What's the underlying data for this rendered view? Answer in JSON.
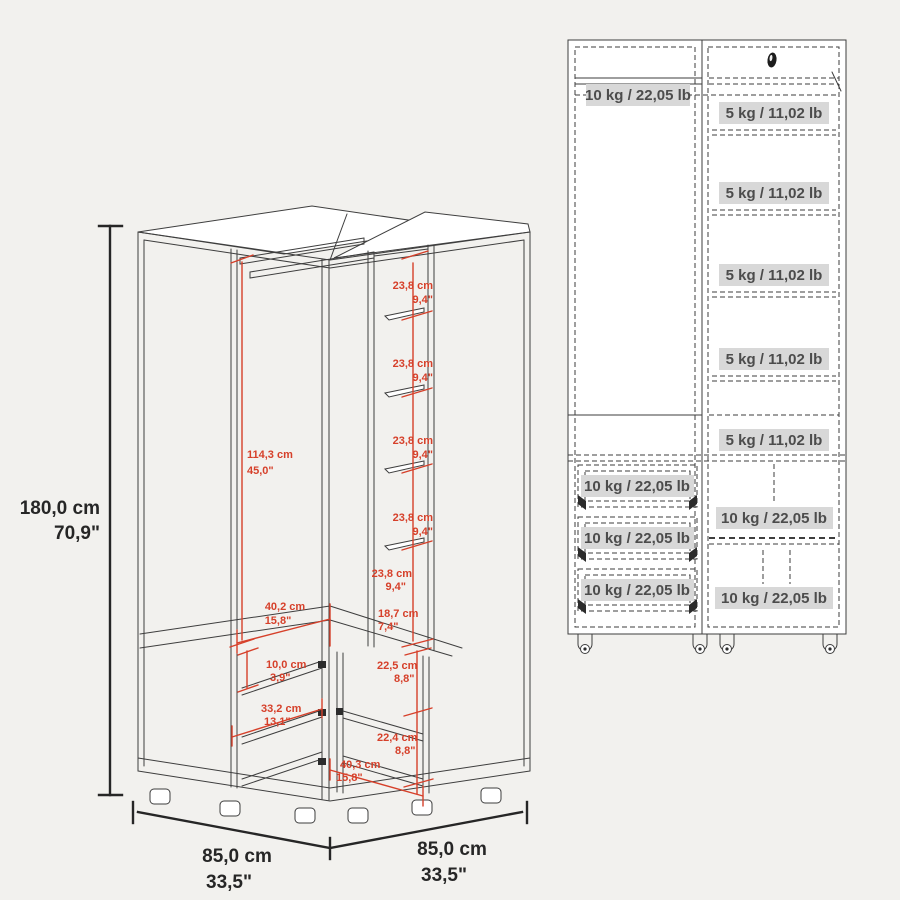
{
  "colors": {
    "background": "#f2f1ee",
    "line": "#3e3e3e",
    "dimension_red": "#d6402a",
    "dimension_black": "#262626",
    "capacity_label_bg": "#d8d8d8",
    "capacity_label_text": "#4c4c4c"
  },
  "left_view": {
    "overall_height": {
      "cm": "180,0 cm",
      "in": "70,9\""
    },
    "base_width_left": {
      "cm": "85,0 cm",
      "in": "33,5\""
    },
    "base_width_right": {
      "cm": "85,0 cm",
      "in": "33,5\""
    },
    "hanging_space_height": {
      "cm": "114,3 cm",
      "in": "45,0\""
    },
    "shelf_gaps": [
      {
        "cm": "23,8 cm",
        "in": "9,4\""
      },
      {
        "cm": "23,8 cm",
        "in": "9,4\""
      },
      {
        "cm": "23,8 cm",
        "in": "9,4\""
      },
      {
        "cm": "23,8 cm",
        "in": "9,4\""
      },
      {
        "cm": "23,8 cm",
        "in": "9,4\""
      }
    ],
    "upper_opening_width": {
      "cm": "40,2 cm",
      "in": "15,8\""
    },
    "side_niche_depth": {
      "cm": "18,7 cm",
      "in": "7,4\""
    },
    "small_cubby_height": {
      "cm": "10,0 cm",
      "in": "3,9\""
    },
    "left_lower_width": {
      "cm": "33,2 cm",
      "in": "13,1\""
    },
    "right_lower_gap_upper": {
      "cm": "22,5 cm",
      "in": "8,8\""
    },
    "right_lower_gap_lower": {
      "cm": "22,4 cm",
      "in": "8,8\""
    },
    "lower_opening_width": {
      "cm": "40,3 cm",
      "in": "15,8\""
    }
  },
  "right_view": {
    "rod_capacity": "10 kg / 22,05 lb",
    "shelves": [
      "5 kg / 11,02 lb",
      "5 kg / 11,02 lb",
      "5 kg / 11,02 lb",
      "5 kg / 11,02 lb",
      "5 kg / 11,02 lb"
    ],
    "drawers": [
      "10 kg / 22,05 lb",
      "10 kg / 22,05 lb",
      "10 kg / 22,05 lb"
    ],
    "lower_shelves": [
      "10 kg / 22,05 lb",
      "10 kg / 22,05 lb"
    ]
  }
}
